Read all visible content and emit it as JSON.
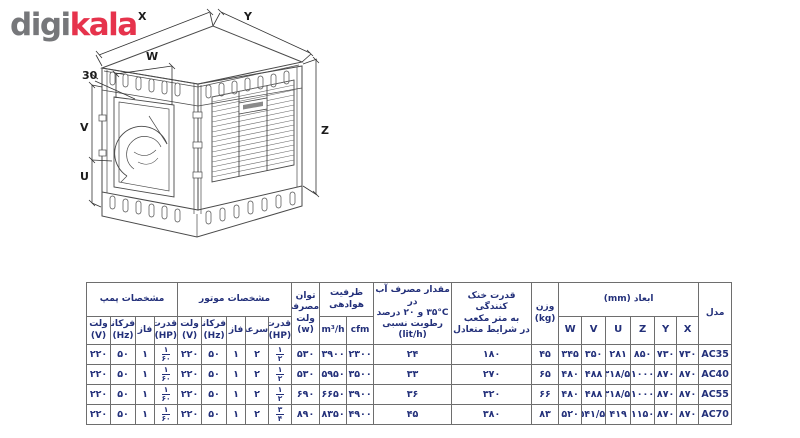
{
  "logo": {
    "digi": "digi",
    "kala": "kala",
    "digi_color": "#76777a",
    "kala_color": "#e6334c"
  },
  "drawing": {
    "description": "isometric technical drawing of evaporative air cooler with dimension callouts",
    "labels": {
      "x": "X",
      "y": "Y",
      "w": "W",
      "z": "Z",
      "v": "V",
      "u": "U",
      "offset": "30"
    }
  },
  "table": {
    "text_color": "#23307a",
    "groups": {
      "pump": "مشخصات پمپ",
      "motor": "مشخصات موتور",
      "air": "ظرفیت هوادهی",
      "dims": "ابعاد (mm)"
    },
    "headers": {
      "model": "مدل",
      "weight": "وزن\n(kg)",
      "cooling": "قدرت خنک کنندگی\nبه متر مکعب\nدر شرایط متعادل",
      "water": "مقدار مصرف آب در\n۳۵°C و ۲۰ درصد\nرطوبت نسبی\n(lit/h)",
      "power": "توان\nمصرفی\nولت\n(w)",
      "m3h": "m³/h",
      "cfm": "cfm",
      "hp": "قدرت\n(HP)",
      "speed": "سرعت",
      "phase": "فاز",
      "freq": "فرکانس\n(Hz)",
      "volt_v": "ولت\n(V)",
      "dim_letters": [
        "X",
        "Y",
        "Z",
        "U",
        "V",
        "W"
      ]
    },
    "rows": [
      [
        "AC35",
        "۷۳۰",
        "۷۳۰",
        "۸۵۰",
        "۲۸۱",
        "۳۵۰",
        "۳۴۵",
        "۴۵",
        "۱۸۰",
        "۲۴",
        "۲۳۰۰",
        "۳۹۰۰",
        "۵۳۰",
        {
          "f": [
            "۱",
            "۲"
          ]
        },
        "۲",
        "۱",
        "۵۰",
        "۲۲۰",
        {
          "f": [
            "۱",
            "۶۰"
          ]
        },
        "۱",
        "۵۰",
        "۲۲۰"
      ],
      [
        "AC40",
        "۸۷۰",
        "۸۷۰",
        "۱۰۰۰",
        "۳۱۸/۵",
        "۴۸۸",
        "۴۸۰",
        "۶۵",
        "۲۷۰",
        "۳۳",
        "۳۵۰۰",
        "۵۹۵۰",
        "۵۳۰",
        {
          "f": [
            "۱",
            "۲"
          ]
        },
        "۲",
        "۱",
        "۵۰",
        "۲۲۰",
        {
          "f": [
            "۱",
            "۶۰"
          ]
        },
        "۱",
        "۵۰",
        "۲۲۰"
      ],
      [
        "AC55",
        "۸۷۰",
        "۸۷۰",
        "۱۰۰۰",
        "۳۱۸/۵",
        "۴۸۸",
        "۴۸۰",
        "۶۶",
        "۳۲۰",
        "۳۶",
        "۳۹۰۰",
        "۶۶۵۰",
        "۶۹۰",
        {
          "f": [
            "۱",
            "۲"
          ]
        },
        "۲",
        "۱",
        "۵۰",
        "۲۲۰",
        {
          "f": [
            "۱",
            "۶۰"
          ]
        },
        "۱",
        "۵۰",
        "۲۲۰"
      ],
      [
        "AC70",
        "۸۷۰",
        "۸۷۰",
        "۱۱۵۰",
        "۴۱۹",
        "۵۴۱/۵",
        "۵۲۰",
        "۸۳",
        "۳۸۰",
        "۴۵",
        "۴۹۰۰",
        "۸۳۵۰",
        "۸۹۰",
        {
          "f": [
            "۳",
            "۴"
          ]
        },
        "۲",
        "۱",
        "۵۰",
        "۲۲۰",
        {
          "f": [
            "۱",
            "۶۰"
          ]
        },
        "۱",
        "۵۰",
        "۲۲۰"
      ]
    ]
  }
}
